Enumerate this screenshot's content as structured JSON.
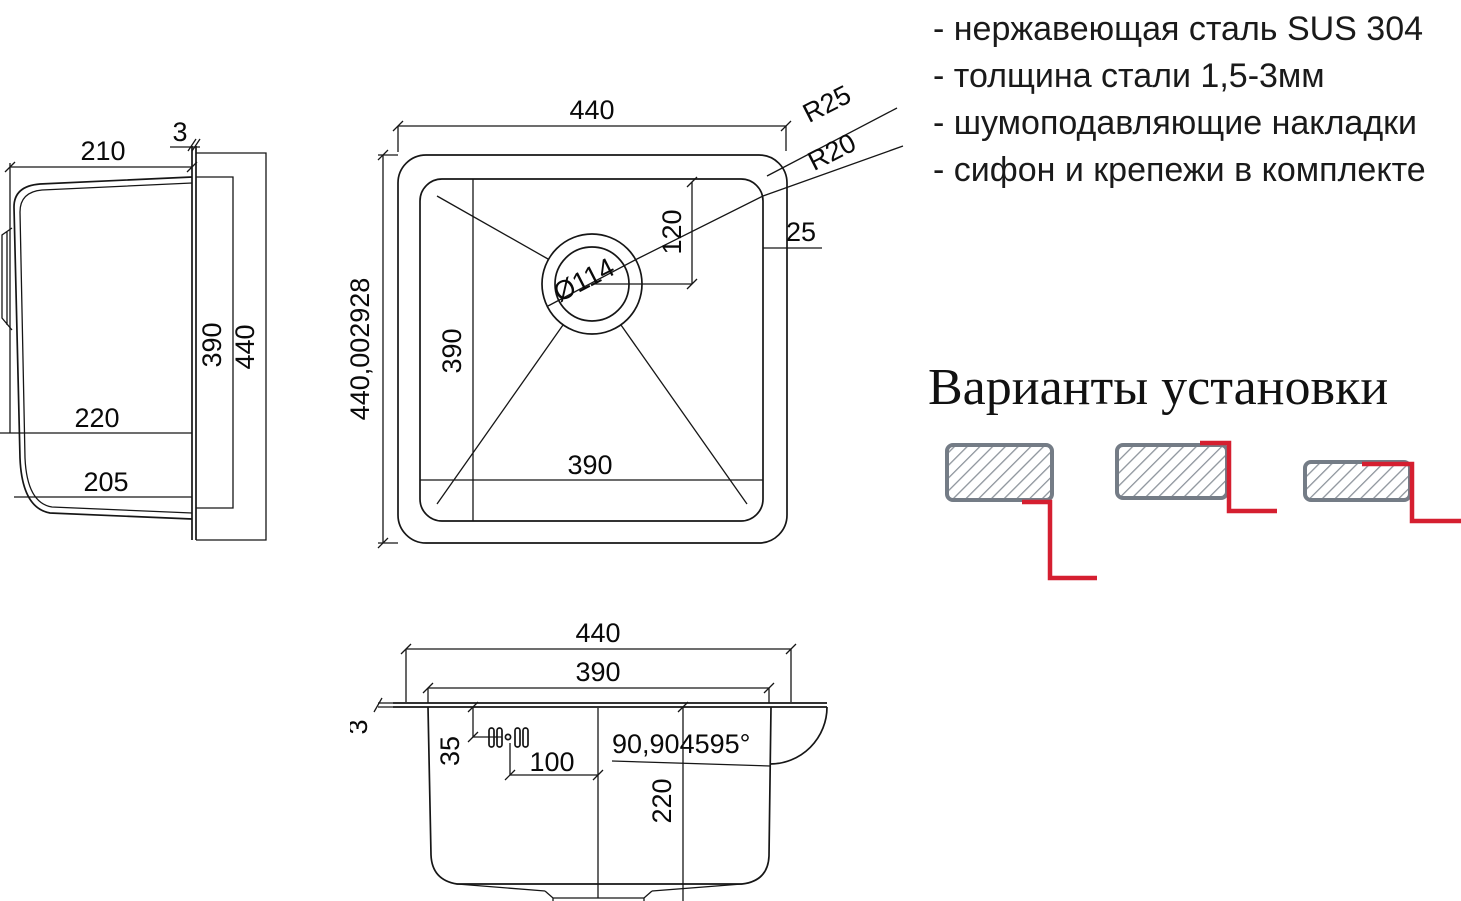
{
  "features": {
    "items": [
      "- нержавеющая сталь SUS 304",
      "- толщина стали 1,5-3мм",
      "- шумоподавляющие накладки",
      "- сифон и крепежи в комплекте"
    ]
  },
  "installation": {
    "title": "Варианты установки",
    "options": [
      "undermount",
      "flush-mount",
      "overmount"
    ]
  },
  "side_view": {
    "top_width": "210",
    "rim_thickness": "3",
    "inner_height": "390",
    "outer_height": "440",
    "depth_upper": "220",
    "depth_lower": "205"
  },
  "top_view": {
    "outer_width": "440",
    "outer_height": "440,002928",
    "inner_height": "390",
    "inner_width": "390",
    "drain_diameter": "Ø114",
    "corner_radius_outer": "R25",
    "corner_radius_inner": "R20",
    "drain_offset": "120",
    "flange_width": "25"
  },
  "front_view": {
    "outer_width": "440",
    "inner_width": "390",
    "rim_thickness": "3",
    "overflow_offset": "35",
    "drain_offset": "100",
    "wall_angle": "90,904595°",
    "bowl_depth": "220"
  },
  "colors": {
    "line": "#161616",
    "accent_red": "#d51f30",
    "install_gray": "#747c86",
    "hatch_gray": "#8d949c"
  }
}
